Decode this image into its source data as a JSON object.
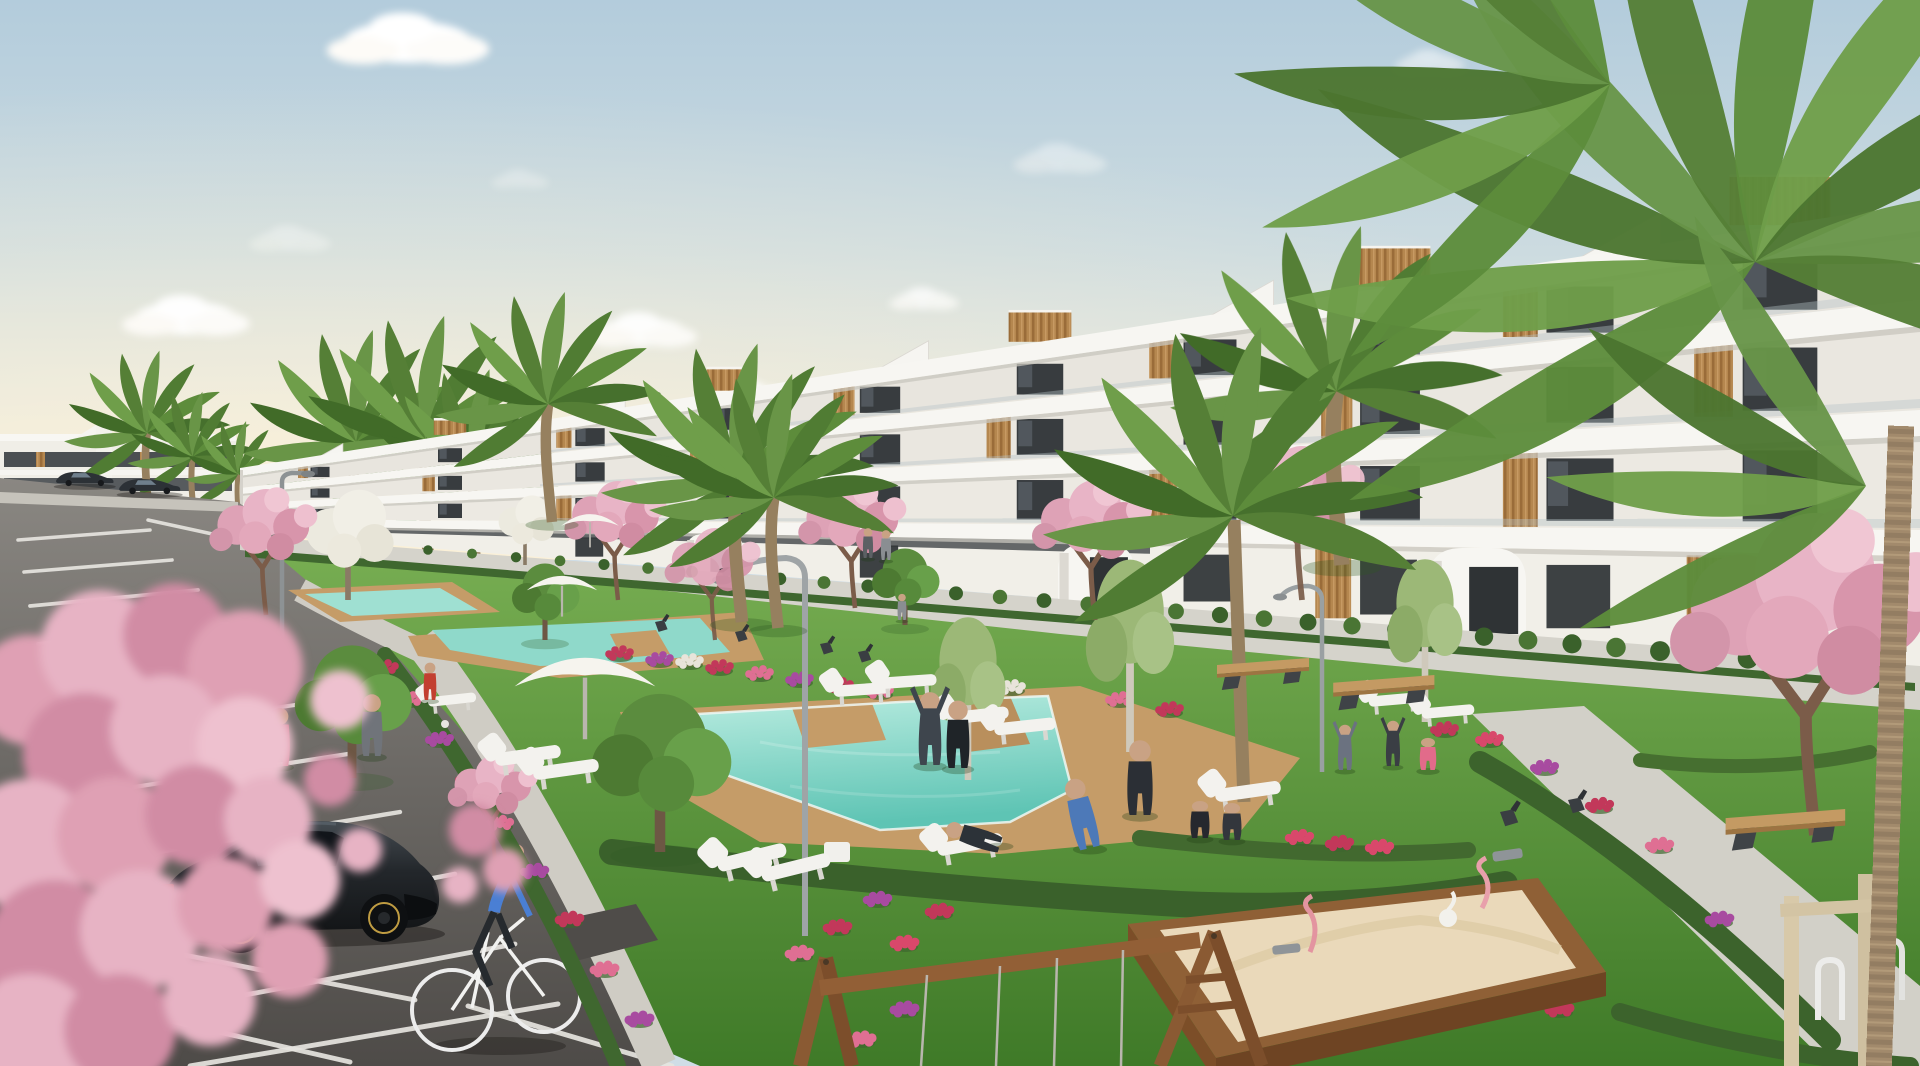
{
  "scene": {
    "type": "architectural-render",
    "palette": {
      "skyTop": "#b3ccdc",
      "skyMid": "#dde4e2",
      "skyHorizon": "#f4ecdb",
      "buildingWhite": "#f7f6f2",
      "wallRecess": "#e9e6df",
      "slabShadow": "#c8c5be",
      "windowDark": "#383c3f",
      "wood": "#b5874f",
      "grassLight": "#7ab054",
      "grassDark": "#3f7a28",
      "hedge": "#3a612b",
      "pool": "#7fd4c4",
      "deck": "#c59c68",
      "path": "#d2cfc7",
      "asphaltFar": "#8a8782",
      "asphaltNear": "#4e4b48",
      "line": "#e6e4df",
      "blossom": "#e3a8ba",
      "palm": "#5d8c3b",
      "trunk": "#96805f",
      "skin": "#c9a284"
    },
    "building": {
      "x0": 240,
      "x1": 1920,
      "lines": {
        "roofT": [
          468,
          203
        ],
        "roofB": [
          476,
          231
        ],
        "s1t": [
          488,
          300
        ],
        "s1b": [
          494,
          326
        ],
        "s2t": [
          504,
          410
        ],
        "s2b": [
          510,
          436
        ],
        "s3t": [
          519,
          530
        ],
        "s3b": [
          525,
          556
        ],
        "gnd": [
          533,
          668
        ]
      },
      "bays": [
        320,
        450,
        590,
        730,
        880,
        1040,
        1210,
        1390,
        1580,
        1780
      ],
      "arches": [
        [
          686,
          534,
          58,
          40
        ],
        [
          1058,
          544,
          76,
          60
        ],
        [
          1428,
          548,
          98,
          86
        ]
      ]
    },
    "clouds": [
      [
        408,
        42,
        1.4,
        1
      ],
      [
        186,
        318,
        1.1,
        0.95
      ],
      [
        642,
        332,
        0.95,
        0.9
      ],
      [
        748,
        398,
        0.85,
        0.9
      ],
      [
        924,
        300,
        0.6,
        0.75
      ],
      [
        1060,
        160,
        0.8,
        0.4
      ],
      [
        290,
        240,
        0.7,
        0.35
      ],
      [
        1430,
        62,
        0.6,
        0.5
      ],
      [
        520,
        180,
        0.5,
        0.3
      ]
    ],
    "farPalms": [
      [
        150,
        520,
        1.4
      ],
      [
        195,
        525,
        1.1
      ],
      [
        240,
        530,
        0.9
      ],
      [
        360,
        560,
        1.9
      ],
      [
        430,
        570,
        2.1
      ],
      [
        478,
        575,
        1.7
      ]
    ],
    "gardenPalms": [
      [
        552,
        522,
        1.9
      ],
      [
        742,
        622,
        2.3
      ],
      [
        778,
        628,
        2.1
      ],
      [
        1342,
        565,
        2.8
      ]
    ],
    "bigPalm": {
      "trunk": [
        [
          1244,
          802
        ],
        [
          1240,
          700
        ],
        [
          1236,
          600
        ],
        [
          1234,
          520
        ]
      ],
      "head": [
        1233,
        516,
        3.2
      ]
    },
    "canopyFans": [
      {
        "x": 1755,
        "y": 262,
        "s": 2.5,
        "a": [
          -200,
          -174,
          -148,
          -122,
          -96,
          -70,
          -44,
          -18,
          6,
          28
        ]
      },
      {
        "x": 1610,
        "y": 84,
        "s": 2.0,
        "a": [
          -216,
          -192,
          -168,
          -144,
          -120,
          -96
        ]
      },
      {
        "x": 1866,
        "y": 486,
        "s": 1.7,
        "a": [
          -196,
          -168,
          -140,
          -112
        ]
      }
    ],
    "blossoms": [
      [
        266,
        615,
        1.8,
        0
      ],
      [
        618,
        600,
        1.7,
        0
      ],
      [
        715,
        640,
        1.6,
        1
      ],
      [
        855,
        608,
        1.8,
        0
      ],
      [
        1095,
        620,
        2.0,
        0
      ],
      [
        1302,
        600,
        2.2,
        1
      ],
      [
        1815,
        835,
        4.6,
        0
      ],
      [
        495,
        860,
        1.5,
        0
      ]
    ],
    "whiteTrees": [
      [
        348,
        600,
        1.9
      ],
      [
        525,
        565,
        1.2
      ]
    ],
    "birchTrees": [
      [
        1130,
        752,
        2.6
      ],
      [
        1425,
        722,
        2.2
      ],
      [
        968,
        780,
        2.2
      ]
    ],
    "greenTrees": [
      [
        352,
        778,
        2.6
      ],
      [
        660,
        852,
        3.1
      ],
      [
        545,
        640,
        1.5
      ],
      [
        905,
        625,
        1.5
      ]
    ],
    "flowerColors": [
      "#c2385a",
      "#a84ba0",
      "#df6f93",
      "#e8e4da",
      "#d9486b"
    ],
    "flowers": [
      [
        385,
        668,
        0
      ],
      [
        410,
        700,
        2
      ],
      [
        440,
        740,
        1
      ],
      [
        470,
        780,
        0
      ],
      [
        500,
        824,
        2
      ],
      [
        535,
        872,
        1
      ],
      [
        570,
        920,
        0
      ],
      [
        605,
        970,
        2
      ],
      [
        640,
        1020,
        1
      ],
      [
        720,
        668,
        0
      ],
      [
        760,
        674,
        2
      ],
      [
        800,
        680,
        1
      ],
      [
        840,
        686,
        0
      ],
      [
        880,
        692,
        2
      ],
      [
        660,
        660,
        1
      ],
      [
        620,
        654,
        0
      ],
      [
        690,
        662,
        3
      ],
      [
        1012,
        688,
        3
      ],
      [
        1120,
        700,
        2
      ],
      [
        1170,
        710,
        0
      ],
      [
        1300,
        838,
        4
      ],
      [
        1340,
        844,
        0
      ],
      [
        1380,
        848,
        4
      ],
      [
        1445,
        730,
        0
      ],
      [
        1490,
        740,
        4
      ],
      [
        878,
        900,
        1
      ],
      [
        838,
        928,
        0
      ],
      [
        800,
        954,
        2
      ],
      [
        905,
        944,
        4
      ],
      [
        940,
        912,
        0
      ],
      [
        1545,
        768,
        1
      ],
      [
        1600,
        806,
        0
      ],
      [
        1660,
        846,
        2
      ],
      [
        1720,
        920,
        1
      ],
      [
        1560,
        1010,
        0
      ],
      [
        905,
        1010,
        1
      ],
      [
        862,
        1040,
        2
      ],
      [
        60,
        1002,
        1
      ],
      [
        126,
        1044,
        0
      ]
    ],
    "hedges": [
      {
        "d": "M612,852 C800,874 1000,894 1180,904 C1310,910 1420,900 1505,884",
        "w": 26,
        "c": "#3a612b"
      },
      {
        "d": "M1140,838 C1260,852 1360,858 1468,850",
        "w": 16,
        "c": "#42692f"
      },
      {
        "d": "M1480,762 C1600,830 1720,930 1830,1040",
        "w": 22,
        "c": "#3c632c"
      },
      {
        "d": "M385,655 C455,745 545,890 618,1066",
        "w": 16,
        "c": "#3f672f"
      },
      {
        "d": "M1640,760 C1720,770 1800,768 1870,752",
        "w": 14,
        "c": "#466f30"
      },
      {
        "d": "M1620,1012 C1720,1042 1820,1060 1910,1066",
        "w": 18,
        "c": "#3c632c"
      }
    ],
    "people": [
      [
        251,
        768,
        3.2,
        "#3f9e98",
        0
      ],
      [
        280,
        766,
        3.1,
        "#cf7589",
        0
      ],
      [
        372,
        756,
        3.3,
        "#70747a",
        0
      ],
      [
        430,
        700,
        2.0,
        "#c23f30",
        0
      ],
      [
        68,
        828,
        0.9,
        "#7a8288",
        0
      ],
      [
        77,
        829,
        0.9,
        "#b46a77",
        0
      ],
      [
        868,
        558,
        1.6,
        "#5c6064",
        0
      ],
      [
        886,
        560,
        1.6,
        "#8a8e92",
        0
      ],
      [
        902,
        620,
        1.4,
        "#8a8e92",
        0
      ],
      [
        930,
        765,
        3.7,
        "#3e454d",
        1
      ],
      [
        958,
        768,
        3.6,
        "#1f2428",
        0
      ],
      [
        1000,
        845,
        3.0,
        "#2c3238",
        2
      ],
      [
        1090,
        848,
        3.8,
        "#4d79b8",
        3
      ],
      [
        1140,
        815,
        4.0,
        "#2b2f35",
        0
      ],
      [
        1200,
        838,
        3.0,
        "#26282e",
        4
      ],
      [
        1232,
        840,
        3.0,
        "#33363c",
        4
      ],
      [
        1345,
        770,
        2.3,
        "#6b7280",
        1
      ],
      [
        1393,
        766,
        2.3,
        "#3a3e44",
        1
      ],
      [
        1428,
        770,
        2.6,
        "#e26b8a",
        4
      ]
    ],
    "loungers": [
      [
        528,
        756,
        -8,
        3.0
      ],
      [
        566,
        770,
        -8,
        3.0
      ],
      [
        752,
        858,
        -14,
        3.2
      ],
      [
        796,
        868,
        -14,
        3.2
      ],
      [
        862,
        690,
        -4,
        2.6
      ],
      [
        908,
        682,
        -4,
        2.6
      ],
      [
        978,
        716,
        -6,
        2.8
      ],
      [
        1025,
        727,
        -6,
        2.8
      ],
      [
        970,
        845,
        -10,
        3.0
      ],
      [
        1248,
        792,
        -8,
        3.0
      ],
      [
        1395,
        700,
        -5,
        2.4
      ],
      [
        1448,
        712,
        -5,
        2.4
      ],
      [
        452,
        700,
        -6,
        2.2
      ]
    ],
    "benches": [
      [
        1225,
        668,
        2.0
      ],
      [
        1342,
        686,
        2.2
      ],
      [
        1736,
        822,
        2.6
      ]
    ],
    "chairs": [
      [
        655,
        622,
        0.9
      ],
      [
        735,
        632,
        0.9
      ],
      [
        820,
        644,
        0.95
      ],
      [
        858,
        652,
        0.95
      ],
      [
        1500,
        812,
        1.3
      ],
      [
        1568,
        800,
        1.2
      ]
    ],
    "umbrellas": [
      [
        585,
        682,
        2.2
      ],
      [
        562,
        588,
        1.1
      ],
      [
        590,
        524,
        0.9
      ]
    ],
    "parkingLines": [
      [
        18,
        540,
        150,
        530
      ],
      [
        24,
        572,
        172,
        560
      ],
      [
        30,
        606,
        198,
        590
      ],
      [
        38,
        644,
        228,
        624
      ],
      [
        48,
        688,
        262,
        662
      ],
      [
        60,
        738,
        302,
        704
      ],
      [
        76,
        796,
        348,
        754
      ],
      [
        98,
        862,
        400,
        812
      ],
      [
        124,
        936,
        455,
        874
      ],
      [
        155,
        1012,
        515,
        944
      ],
      [
        190,
        1066,
        558,
        1004
      ],
      [
        88,
        1002,
        350,
        1062
      ],
      [
        148,
        948,
        415,
        1000
      ],
      [
        468,
        1006,
        672,
        1066
      ],
      [
        585,
        952,
        840,
        1066
      ],
      [
        252,
        522,
        380,
        556
      ],
      [
        148,
        520,
        240,
        540
      ]
    ],
    "parkedCars": [
      [
        55,
        470,
        0.62,
        0
      ],
      [
        118,
        477,
        0.66,
        0
      ],
      [
        205,
        628,
        0.85,
        1
      ],
      [
        52,
        700,
        1.05,
        0
      ],
      [
        386,
        576,
        0.9,
        1
      ],
      [
        518,
        586,
        1.5,
        1
      ]
    ],
    "foreBlossom": [
      [
        30,
        690,
        55,
        0
      ],
      [
        100,
        650,
        60,
        1
      ],
      [
        175,
        635,
        52,
        2
      ],
      [
        245,
        668,
        58,
        0
      ],
      [
        85,
        755,
        62,
        2
      ],
      [
        165,
        730,
        55,
        1
      ],
      [
        245,
        745,
        48,
        3
      ],
      [
        28,
        845,
        66,
        1
      ],
      [
        115,
        835,
        58,
        0
      ],
      [
        195,
        815,
        50,
        2
      ],
      [
        268,
        820,
        44,
        1
      ],
      [
        55,
        950,
        70,
        2
      ],
      [
        140,
        930,
        60,
        1
      ],
      [
        225,
        905,
        48,
        0
      ],
      [
        300,
        880,
        40,
        3
      ],
      [
        30,
        1040,
        66,
        1
      ],
      [
        120,
        1030,
        56,
        2
      ],
      [
        210,
        1000,
        46,
        1
      ],
      [
        290,
        960,
        38,
        0
      ],
      [
        340,
        700,
        30,
        3
      ],
      [
        330,
        780,
        26,
        2
      ],
      [
        360,
        850,
        22,
        1
      ],
      [
        475,
        830,
        26,
        2
      ],
      [
        505,
        870,
        22,
        0
      ],
      [
        460,
        885,
        18,
        1
      ]
    ],
    "foreBlossomColors": [
      "#dfa0b4",
      "#e7b3c4",
      "#d18ca4",
      "#eec1cf",
      "#c87d96"
    ]
  }
}
